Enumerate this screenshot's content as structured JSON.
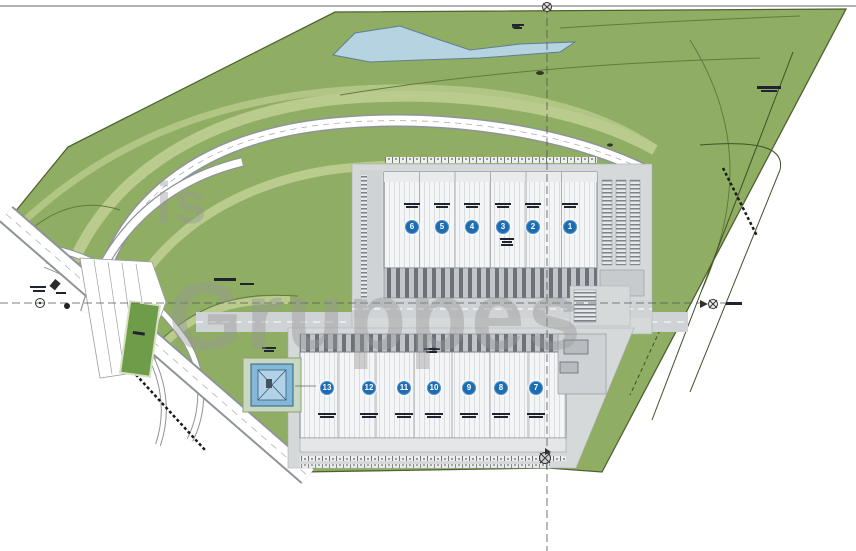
{
  "watermark": {
    "line1": "is",
    "line2": "Gruppes"
  },
  "buildings": {
    "north": {
      "units": [
        {
          "number": "6"
        },
        {
          "number": "5"
        },
        {
          "number": "4"
        },
        {
          "number": "3"
        },
        {
          "number": "2"
        },
        {
          "number": "1"
        }
      ]
    },
    "south": {
      "units": [
        {
          "number": "13"
        },
        {
          "number": "12"
        },
        {
          "number": "11"
        },
        {
          "number": "10"
        },
        {
          "number": "9"
        },
        {
          "number": "8"
        },
        {
          "number": "7"
        }
      ]
    }
  },
  "colors": {
    "site_green": "#8fae63",
    "terrace_green": "#b9cb8d",
    "field_green": "#6f9c49",
    "pond_blue": "#b6d3e2",
    "building_fill": "#f4f5f6",
    "road_gray": "#cfd3d6",
    "dock_gray": "#6d7279",
    "unit_marker_blue": "#1c6cb4",
    "basin_blue": "#85b7d8",
    "outline_green": "#4e6130",
    "watermark_gray": "#969696"
  }
}
